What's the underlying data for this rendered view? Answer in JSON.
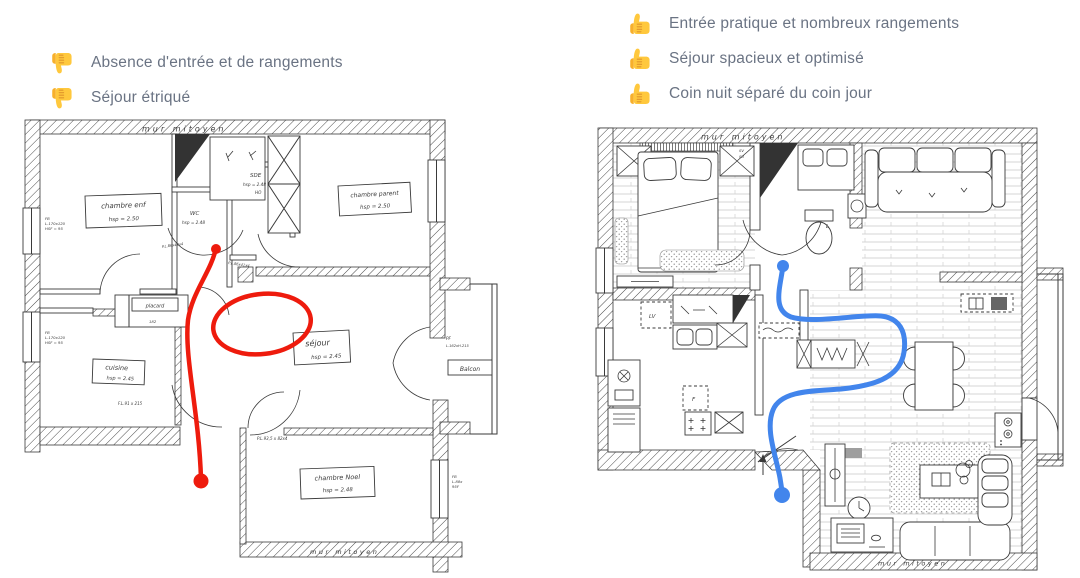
{
  "colors": {
    "text_gray": "#6a7383",
    "annotation_red": "#ee1b0d",
    "annotation_blue": "#4285ec",
    "ink": "#3b3b3b",
    "emoji_yellow": "#FFC83D",
    "emoji_shade": "#E0952B"
  },
  "before_panel": {
    "verdicts": [
      {
        "icon": "thumbs-down",
        "label": "Absence d'entrée et de rangements"
      },
      {
        "icon": "thumbs-down",
        "label": "Séjour étriqué"
      }
    ],
    "plan_labels": {
      "mur_top": "mur mitoyen",
      "mur_bottom": "mur mitoyen",
      "chambre_enf": "chambre enf",
      "chambre_enf_hsp": "hsp = 2.50",
      "chambre_parent": "chambre parent",
      "chambre_parent_hsp": "hsp = 2.50",
      "wc": "WC",
      "wc_hsp": "hsp = 2.48",
      "sde": "SDE",
      "sde_hsp": "hsp = 2.48",
      "sde_ho": "HO",
      "sejour": "séjour",
      "sejour_hsp": "hsp = 2.45",
      "cuisine": "cuisine",
      "cuisine_hsp": "hsp = 2.45",
      "placard": "placard",
      "placard_dim": "182",
      "chambre_noel": "chambre Noel",
      "chambre_noel_hsp": "hsp = 2.48",
      "balcon": "Balcon",
      "pf": "PF",
      "pf_dim": "L.162xH.215",
      "fb1": "FB",
      "fb1_dim": "L.170x120",
      "fb1_h": "HSF = 95",
      "fb2": "FB",
      "fb2_dim": "L.170x120",
      "fb2_h": "HSF = 95",
      "fbr": "FB",
      "fbr_dim": "L.88x",
      "fbr_h": "95F",
      "door1": "P.L.86x42x4",
      "door2": "P.L.86x41x4",
      "door3": "F.L.91 x 215",
      "door4": "P.L.93,5 x 82x4",
      "dim90": "90"
    }
  },
  "after_panel": {
    "verdicts": [
      {
        "icon": "thumbs-up",
        "label": "Entrée pratique et nombreux rangements"
      },
      {
        "icon": "thumbs-up",
        "label": "Séjour spacieux et optimisé"
      },
      {
        "icon": "thumbs-up",
        "label": "Coin nuit séparé du coin jour"
      }
    ],
    "plan_labels": {
      "mur_top": "mur mitoyen",
      "mur_bottom": "mur mitoyen",
      "lv": "LV",
      "f": "F",
      "l": "L",
      "sv": "SV",
      "su": "SU"
    }
  }
}
